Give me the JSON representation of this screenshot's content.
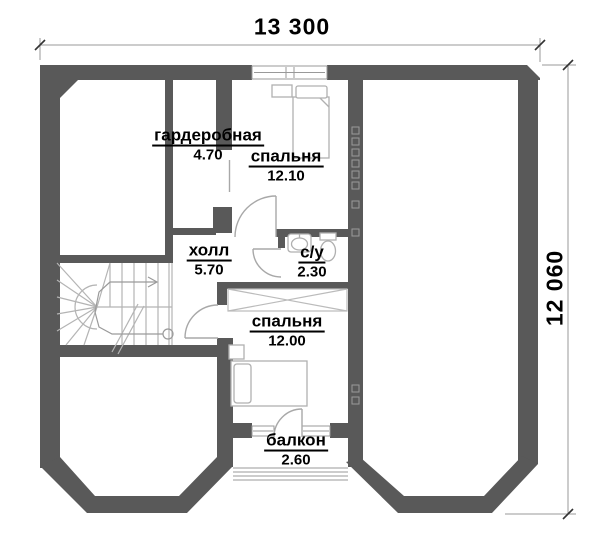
{
  "plan_title": "second-floor-plan",
  "dimensions": {
    "width_label": "13 300",
    "height_label": "12 060"
  },
  "rooms": [
    {
      "name": "гардеробная",
      "area": "4.70"
    },
    {
      "name": "спальня",
      "area": "12.10"
    },
    {
      "name": "холл",
      "area": "5.70"
    },
    {
      "name": "с/у",
      "area": "2.30"
    },
    {
      "name": "спальня",
      "area": "12.00"
    },
    {
      "name": "балкон",
      "area": "2.60"
    }
  ],
  "fixtures": [
    "stairs-with-up-arrow",
    "bed",
    "bed",
    "nightstand",
    "nightstand",
    "sink",
    "toilet",
    "wardrobe-crossed",
    "balcony-railing",
    "window",
    "window",
    "window",
    "door-arc",
    "door-arc",
    "door-arc",
    "door-arc",
    "vent-squares"
  ],
  "colors": {
    "wall": "#595959",
    "furniture_line": "#b0b0b0",
    "door_line": "#a8a8a8",
    "window_line": "#999999",
    "stair_line": "#b4b4b4",
    "dim_line": "#999999",
    "text": "#000000",
    "background": "#ffffff"
  }
}
